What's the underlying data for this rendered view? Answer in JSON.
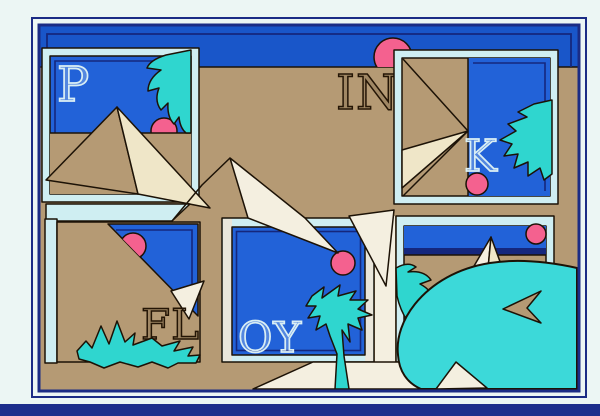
{
  "artwork": {
    "word_spelled": "PINK FLOYD",
    "letters": {
      "p": "P",
      "in": "IN",
      "k": "K",
      "fl": "FL",
      "oy": "OY",
      "d": "D"
    },
    "scene_elements": [
      "desert",
      "sky",
      "pyramids",
      "palm-trees",
      "pink-suns",
      "framed-window-panels"
    ],
    "colors": {
      "page_bg": "#ecf6f4",
      "photo_edge_navy": "#1d2e8c",
      "frame_navy": "#1b2c85",
      "desert_tan": "#b59a74",
      "sky_blue": "#1956c9",
      "panel_blue": "#2262d8",
      "pinstripe_navy": "#15277d",
      "pale_cyan": "#cfeef2",
      "warm_white": "#eae6da",
      "turquoise": "#2fd6cf",
      "big_leaf_turquoise": "#3cd9d9",
      "sun_pink": "#f4618f",
      "cream": "#efe6c8",
      "white_cream": "#f4efe0",
      "outline": "#1c1206",
      "letter_pale": "#d9eef4",
      "letter_dark": "#241505"
    }
  }
}
